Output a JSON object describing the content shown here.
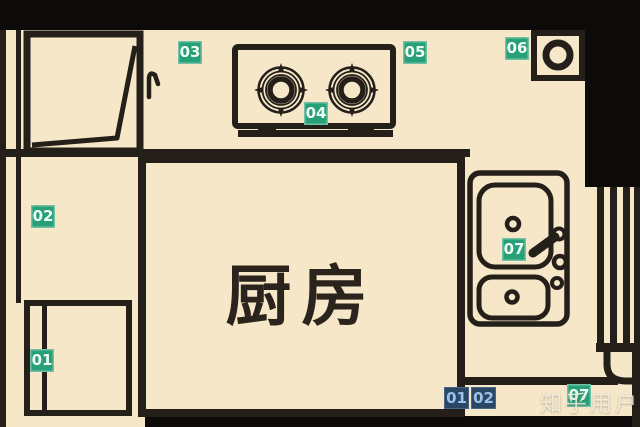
{
  "room": {
    "label": "厨房"
  },
  "watermark": {
    "text": "知乎用户"
  },
  "markers": [
    {
      "id": "03",
      "label": "03",
      "color": "green",
      "area": "top-counter-left"
    },
    {
      "id": "05",
      "label": "05",
      "color": "green",
      "area": "top-counter-right"
    },
    {
      "id": "06",
      "label": "06",
      "color": "green",
      "area": "flue-corner"
    },
    {
      "id": "04",
      "label": "04",
      "color": "green",
      "area": "stove"
    },
    {
      "id": "07",
      "label": "07",
      "color": "green",
      "area": "sink"
    },
    {
      "id": "02",
      "label": "02",
      "color": "green",
      "area": "left-counter"
    },
    {
      "id": "01",
      "label": "01",
      "color": "green",
      "area": "bottom-left-cabinet"
    },
    {
      "id": "01b",
      "label": "01",
      "color": "blue",
      "area": "bottom-strip"
    },
    {
      "id": "02b",
      "label": "02",
      "color": "blue",
      "area": "bottom-strip"
    },
    {
      "id": "07b",
      "label": "07",
      "color": "green",
      "area": "bottom-right-corner"
    }
  ],
  "fixtures": [
    "cabinet-with-door-swing",
    "gas-stove-two-burners",
    "flue-hole",
    "double-basin-sink-with-faucet",
    "window-right-wall",
    "fridge-cabinet-bottom-left"
  ],
  "colors": {
    "floor": "#f6e7c9",
    "line": "#241f19",
    "wall": "#0d0b09",
    "badge_green": "#27a077",
    "badge_green_text": "#f0fbf4",
    "badge_blue": "#2c4766",
    "badge_blue_text": "#9dc2ea",
    "watermark_text": "#f6f0e2",
    "room_text": "#2a241d"
  }
}
